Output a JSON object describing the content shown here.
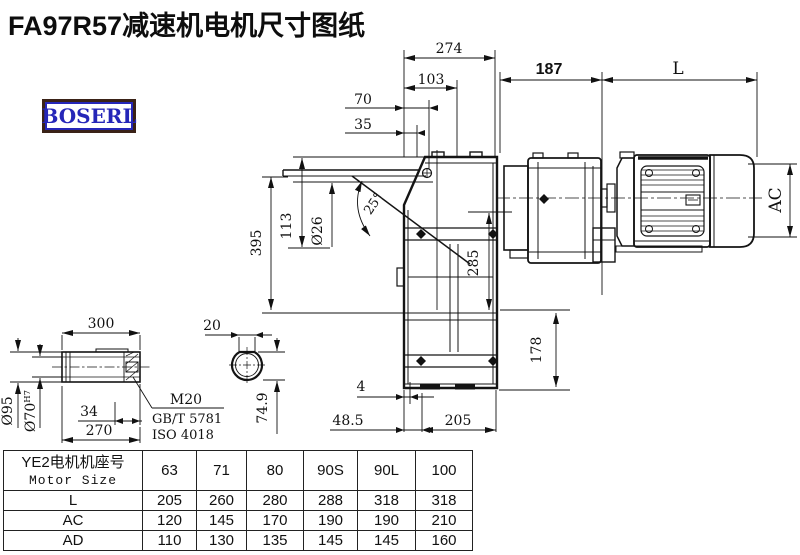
{
  "title": "FA97R57减速机电机尺寸图纸",
  "logo": "BOSERL",
  "drawing": {
    "dims": {
      "width_274": "274",
      "width_103": "103",
      "width_70": "70",
      "width_35": "35",
      "len_187": "187",
      "len_L": "L",
      "motor_ac": "AC",
      "height_395": "395",
      "height_113": "113",
      "dia_26": "Ø26",
      "angle_25": "25°",
      "height_285": "285",
      "height_178": "178",
      "gap_4": "4",
      "offset_48_5": "48.5",
      "width_205": "205"
    },
    "shaft_detail": {
      "len_300": "300",
      "dia_95": "Ø95",
      "dia_70": "Ø70",
      "tol_h7": "H7",
      "len_34": "34",
      "len_270": "270",
      "thread": "M20",
      "std_gb": "GB/T 5781",
      "std_iso": "ISO 4018",
      "key_20": "20",
      "key_74_9": "74.9"
    }
  },
  "table": {
    "header_cn": "YE2电机机座号",
    "header_en": "Motor Size",
    "sizes": [
      "63",
      "71",
      "80",
      "90S",
      "90L",
      "100"
    ],
    "rows": [
      {
        "label": "L",
        "values": [
          "205",
          "260",
          "280",
          "288",
          "318",
          "318"
        ]
      },
      {
        "label": "AC",
        "values": [
          "120",
          "145",
          "170",
          "190",
          "190",
          "210"
        ]
      },
      {
        "label": "AD",
        "values": [
          "110",
          "130",
          "135",
          "145",
          "145",
          "160"
        ]
      }
    ]
  }
}
